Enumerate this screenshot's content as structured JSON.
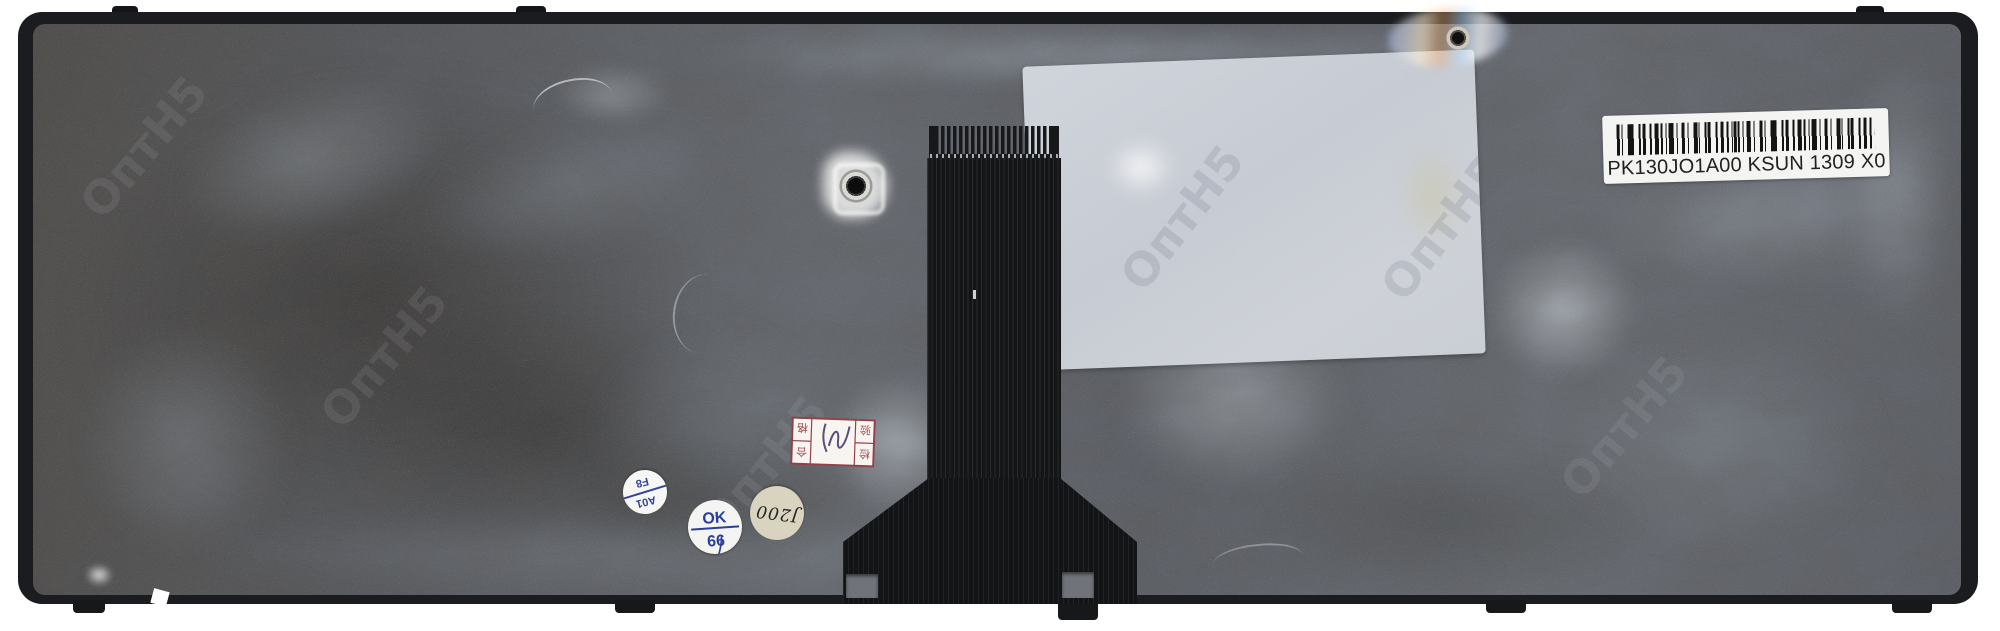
{
  "barcode_label": {
    "text": "PK130JO1A00 KSUN 1309 X0"
  },
  "round_stickers": [
    {
      "line1": "A01",
      "line2": "F8"
    },
    {
      "line1": "OK",
      "line2": "66"
    },
    {
      "text": "J200"
    }
  ],
  "qc_stamp": {
    "l1": "检",
    "l2": "验",
    "r1": "合",
    "r2": "格"
  },
  "watermark": {
    "text": "ОптН5"
  }
}
